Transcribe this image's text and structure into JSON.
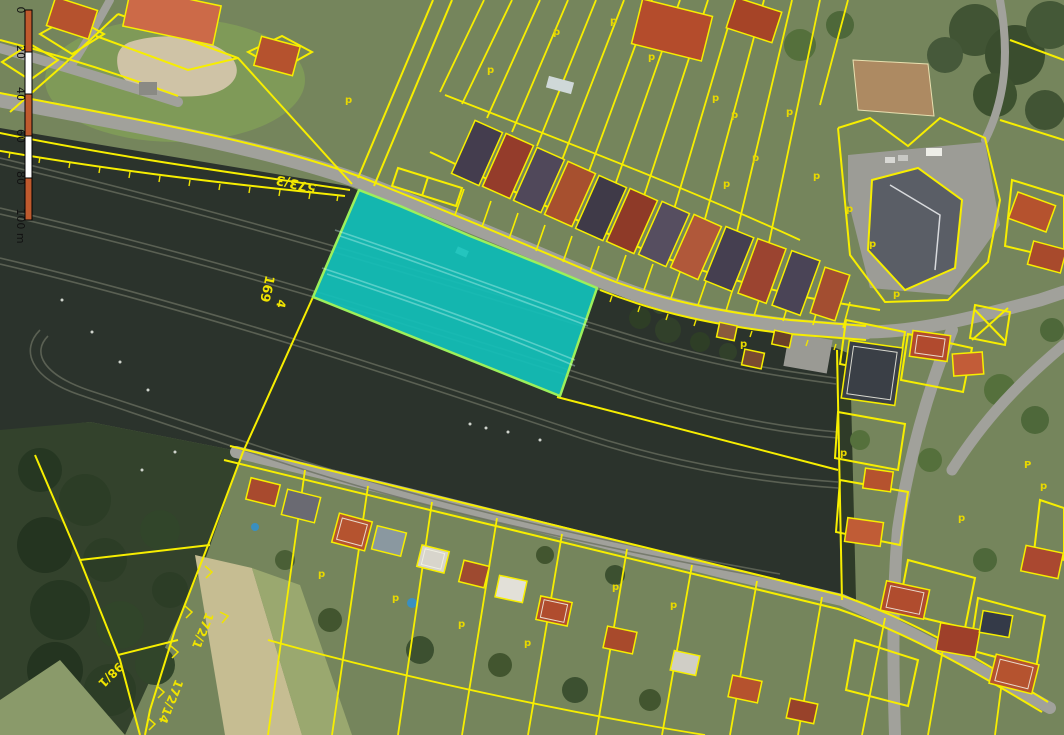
{
  "scalebar": {
    "tick_labels": [
      "0",
      "20",
      "40",
      "60",
      "80",
      "100 m"
    ],
    "unit": "m",
    "filled_color": "#bf5a2e",
    "empty_color": "#ffffff",
    "outline_color": "#000000"
  },
  "map": {
    "highlighted_parcel": {
      "fill_color": "#12c1bb",
      "border_color": "#9cf05c"
    },
    "cadastral_line_color": "#f7ee00",
    "parcel_labels": [
      {
        "text": "573/3"
      },
      {
        "text": "169"
      },
      {
        "text": "4"
      },
      {
        "text": "172/1"
      },
      {
        "text": "98/1"
      },
      {
        "text": "172/14"
      }
    ],
    "landuse_symbol": "p",
    "landuse_symbol_large": "P"
  }
}
